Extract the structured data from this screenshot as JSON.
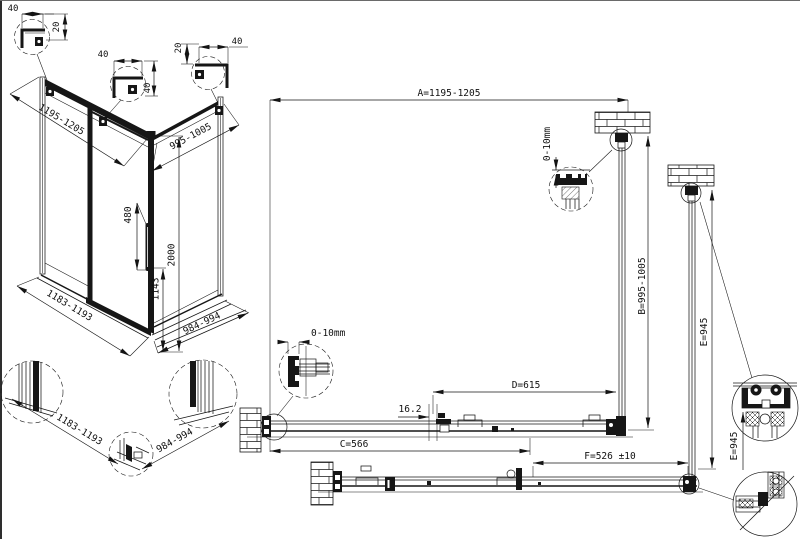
{
  "drawing_title": "Shower enclosure technical drawing",
  "corner_details": {
    "left": {
      "width": "40",
      "height": "20"
    },
    "middle": {
      "width": "40",
      "height": "40"
    },
    "right": {
      "width": "40",
      "height": "20"
    }
  },
  "isometric": {
    "top_width": "1195-1205",
    "top_depth": "995-1005",
    "handle_length": "480",
    "total_height": "2000",
    "handle_height": "1143",
    "bottom_width": "1183-1193",
    "bottom_depth": "984-994"
  },
  "base_details": {
    "front_width": "1183-1193",
    "side_width": "984-994"
  },
  "plan": {
    "dim_a": "A=1195-1205",
    "dim_b": "B=995-1005",
    "dim_c": "C=566",
    "dim_d": "D=615",
    "dim_e": "E=945",
    "dim_e_detail": "E=945",
    "dim_f": "F=526 ±10",
    "dim_gap": "16.2",
    "wall_gap_side": "0-10mm",
    "wall_gap_front": "0-10mm"
  }
}
